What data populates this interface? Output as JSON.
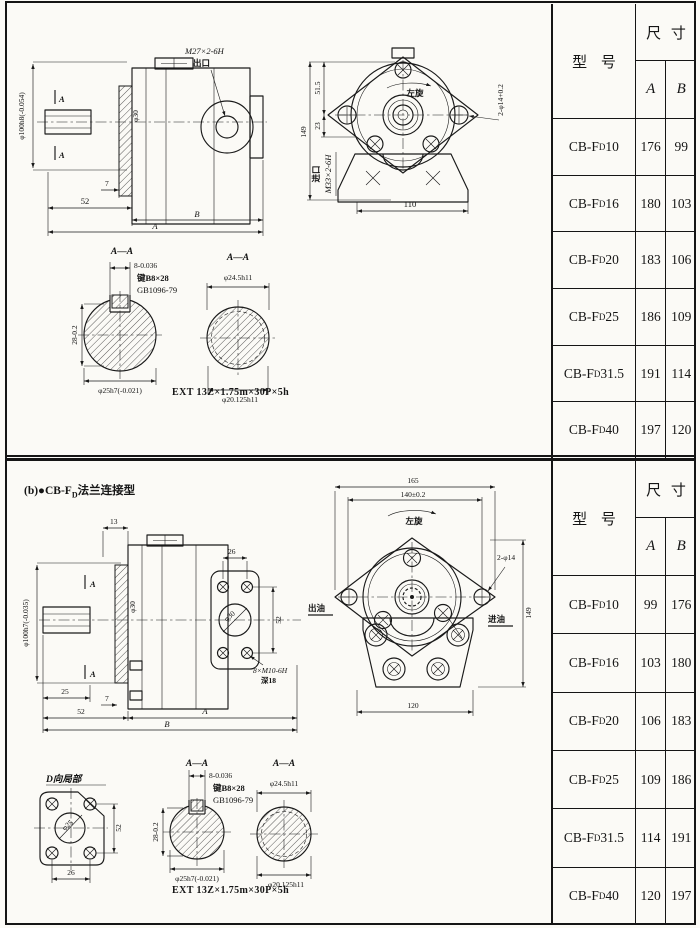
{
  "top": {
    "side_view": {
      "shaft_dia": "φ100h8(-0.054)",
      "section_mark": "A",
      "thread": "M27×2-6H",
      "port": "出口",
      "hub_dia": "φ30",
      "dim_7": "7",
      "dim_52": "52",
      "dim_B": "B",
      "dim_A": "A"
    },
    "front_view": {
      "rotation": "左旋",
      "dim_51_5": "51.5",
      "dim_23": "23",
      "dim_149": "149",
      "inlet_port": "进口",
      "inlet_thread": "M33×2-6H",
      "holes": "2-φ14+0.2",
      "dim_110": "110"
    },
    "section_key": {
      "title": "A—A",
      "key_width": "8-0.036",
      "key_spec": "键B8×28",
      "key_std": "GB1096-79",
      "height": "28-0.2",
      "shaft": "φ25h7(-0.021)"
    },
    "section_spline": {
      "title": "A—A",
      "outer": "φ24.5h11",
      "inner": "φ20.125h11"
    },
    "spline_note": "EXT 13Z×1.75m×30P×5h",
    "table": {
      "model_header": "型 号",
      "size_header": "尺 寸",
      "col_a": "A",
      "col_b": "B",
      "rows": [
        {
          "prefix": "CB-F",
          "sub": "D",
          "num": "10",
          "a": "176",
          "b": "99"
        },
        {
          "prefix": "CB-F",
          "sub": "D",
          "num": "16",
          "a": "180",
          "b": "103"
        },
        {
          "prefix": "CB-F",
          "sub": "D",
          "num": "20",
          "a": "183",
          "b": "106"
        },
        {
          "prefix": "CB-F",
          "sub": "D",
          "num": "25",
          "a": "186",
          "b": "109"
        },
        {
          "prefix": "CB-F",
          "sub": "D",
          "num": "31.5",
          "a": "191",
          "b": "114"
        },
        {
          "prefix": "CB-F",
          "sub": "D",
          "num": "40",
          "a": "197",
          "b": "120"
        }
      ]
    }
  },
  "bottom": {
    "title_prefix": "(b)●CB-F",
    "title_sub": "D",
    "title_suffix": "法兰连接型",
    "side_view": {
      "dim_13": "13",
      "shaft_dia": "φ100h7(-0.035)",
      "section_mark": "A",
      "hub_dia": "φ30",
      "dim_26": "26",
      "flange_bore": "φ30",
      "dim_52_v": "52",
      "bolt_thread": "8×M10-6H",
      "bolt_depth": "深18",
      "dim_25": "25",
      "dim_7": "7",
      "dim_52": "52",
      "dim_A": "A",
      "dim_B": "B"
    },
    "front_view": {
      "dim_165": "165",
      "dim_140": "140±0.2",
      "rotation": "左旋",
      "holes": "2-φ14",
      "outlet": "出油",
      "inlet": "进油",
      "dim_149": "149",
      "dim_120": "120"
    },
    "detail_d": {
      "title": "D向局部",
      "bore": "φ25",
      "dim_52": "52",
      "dim_26": "26"
    },
    "section_key": {
      "title": "A—A",
      "key_width": "8-0.036",
      "key_spec": "键B8×28",
      "key_std": "GB1096-79",
      "height": "28-0.2",
      "shaft": "φ25h7(-0.021)"
    },
    "section_spline": {
      "title": "A—A",
      "outer": "φ24.5h11",
      "inner": "φ20.125h11"
    },
    "spline_note": "EXT 13Z×1.75m×30P×5h",
    "table": {
      "model_header": "型 号",
      "size_header": "尺 寸",
      "col_a": "A",
      "col_b": "B",
      "rows": [
        {
          "prefix": "CB-F",
          "sub": "D",
          "num": "10",
          "a": "99",
          "b": "176"
        },
        {
          "prefix": "CB-F",
          "sub": "D",
          "num": "16",
          "a": "103",
          "b": "180"
        },
        {
          "prefix": "CB-F",
          "sub": "D",
          "num": "20",
          "a": "106",
          "b": "183"
        },
        {
          "prefix": "CB-F",
          "sub": "D",
          "num": "25",
          "a": "109",
          "b": "186"
        },
        {
          "prefix": "CB-F",
          "sub": "D",
          "num": "31.5",
          "a": "114",
          "b": "191"
        },
        {
          "prefix": "CB-F",
          "sub": "D",
          "num": "40",
          "a": "120",
          "b": "197"
        }
      ]
    }
  }
}
